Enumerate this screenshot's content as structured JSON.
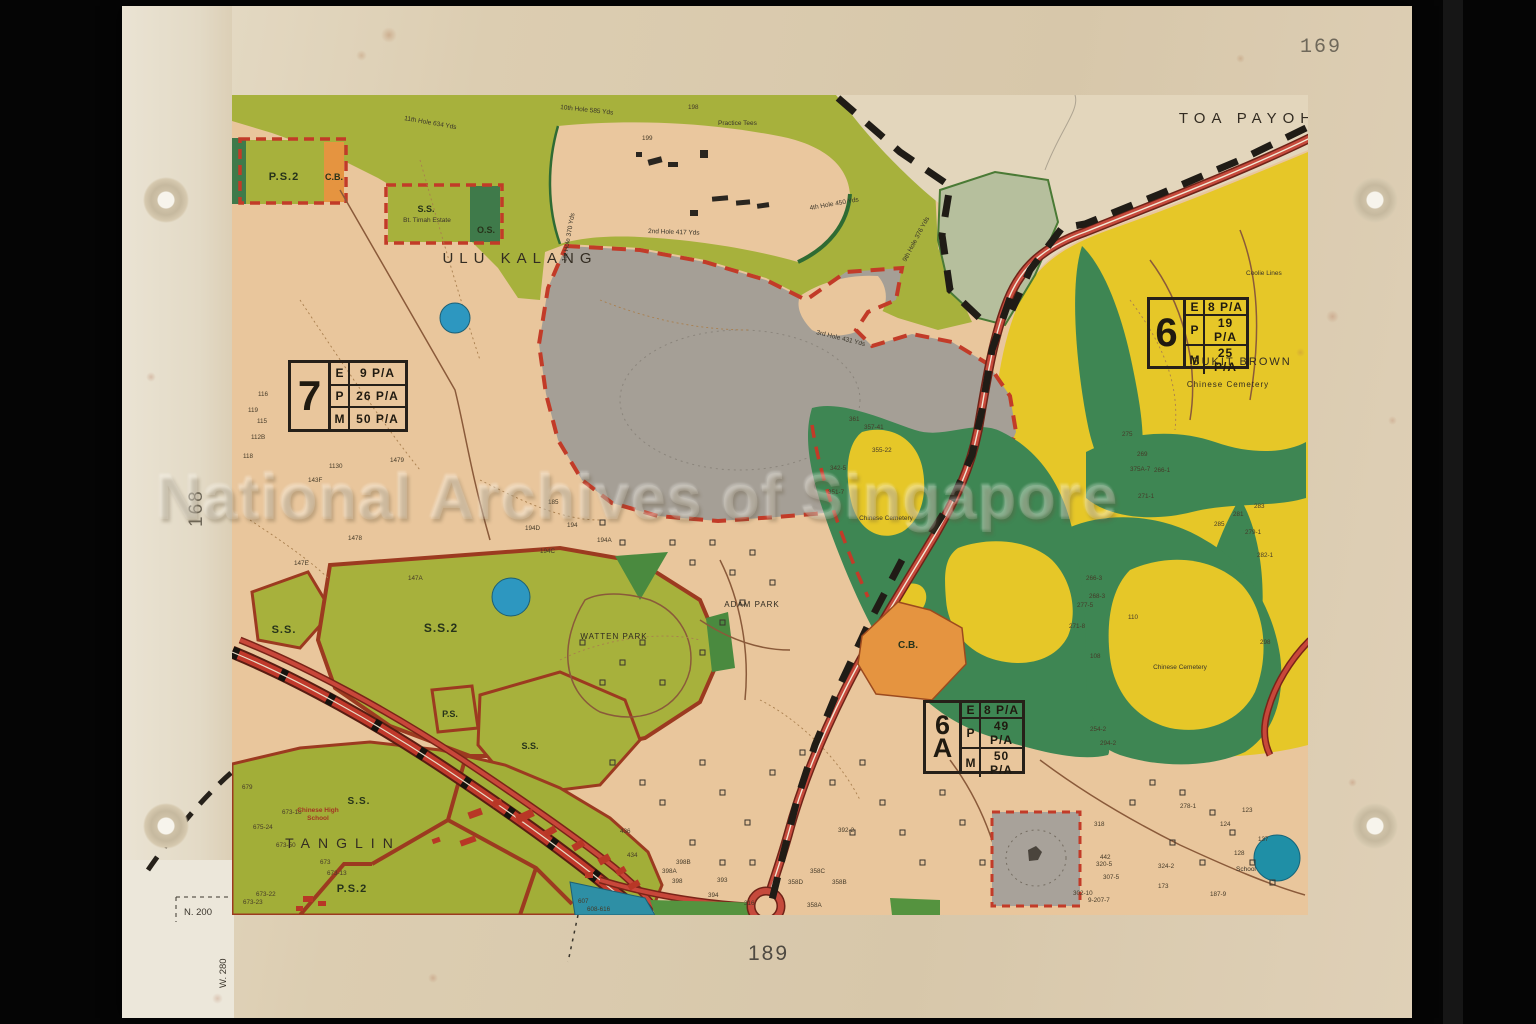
{
  "page": {
    "sheet_number": "169",
    "adjacent_sheet_left": "168",
    "adjacent_sheet_bottom": "189",
    "grid_north_label": "N. 200",
    "grid_west_label": "W. 280"
  },
  "watermark": "National Archives of Singapore",
  "places": {
    "toa_payoh": "TOA PAYOH",
    "ulu_kalang": "ULU KALANG",
    "tanglin": "TANGLIN",
    "ulu_pandan": "ULU PANDAN",
    "bukit_brown": "BUKIT BROWN",
    "adam_park": "ADAM PARK",
    "watten_park": "WATTEN PARK",
    "chinese_cemetery_1": "Chinese Cemetery",
    "chinese_cemetery_2": "Chinese Cemetery",
    "chinese_cemetery_3": "Chinese Cemetery",
    "coolie_lines": "Coolie Lines",
    "practice_tees": "Practice Tees",
    "chinese_high_line1": "Chinese High",
    "chinese_high_line2": "School",
    "school": "School"
  },
  "zones": {
    "ps2_top": "P.S.2",
    "cb_top": "C.B.",
    "ss_estate": "S.S.",
    "bt_timah_estate": "Bt. Timah Estate",
    "os": "O.S.",
    "ss_left": "S.S.",
    "ss2": "S.S.2",
    "ps": "P.S.",
    "ss_mid": "S.S.",
    "ss_tanglin": "S.S.",
    "ps2_bottom": "P.S.2",
    "cb_mid": "C.B."
  },
  "density_boxes": [
    {
      "id_top": "7",
      "id_bottom": "",
      "rows": [
        [
          "E",
          "9 P/A"
        ],
        [
          "P",
          "26 P/A"
        ],
        [
          "M",
          "50 P/A"
        ]
      ]
    },
    {
      "id_top": "6",
      "id_bottom": "",
      "rows": [
        [
          "E",
          "8 P/A"
        ],
        [
          "P",
          "19 P/A"
        ],
        [
          "M",
          "25 P/A"
        ]
      ]
    },
    {
      "id_top": "6",
      "id_bottom": "A",
      "rows": [
        [
          "E",
          "8 P/A"
        ],
        [
          "P",
          "49 P/A"
        ],
        [
          "M",
          "50 P/A"
        ]
      ]
    }
  ],
  "golf_labels": [
    {
      "t": "10th Hole 585 Yds",
      "x": 560,
      "y": 109,
      "r": 6
    },
    {
      "t": "11th Hole 634 Yds",
      "x": 404,
      "y": 120,
      "r": 10
    },
    {
      "t": "2nd Hole 417 Yds",
      "x": 648,
      "y": 233,
      "r": 2
    },
    {
      "t": "4th Hole 450 Yds",
      "x": 810,
      "y": 210,
      "r": -10
    },
    {
      "t": "1st Hole 370 Yds",
      "x": 566,
      "y": 262,
      "r": -80
    },
    {
      "t": "9th Hole 376 Yds",
      "x": 906,
      "y": 262,
      "r": -62
    },
    {
      "t": "3rd Hole 431 Yds",
      "x": 816,
      "y": 334,
      "r": 14
    }
  ],
  "parcel_labels": [
    {
      "t": "116",
      "x": 258,
      "y": 396
    },
    {
      "t": "119",
      "x": 248,
      "y": 412
    },
    {
      "t": "115",
      "x": 257,
      "y": 423
    },
    {
      "t": "112B",
      "x": 251,
      "y": 439
    },
    {
      "t": "118",
      "x": 243,
      "y": 458
    },
    {
      "t": "1130",
      "x": 329,
      "y": 468
    },
    {
      "t": "143F",
      "x": 308,
      "y": 482
    },
    {
      "t": "1479",
      "x": 390,
      "y": 462
    },
    {
      "t": "147E",
      "x": 294,
      "y": 565
    },
    {
      "t": "1478",
      "x": 348,
      "y": 540
    },
    {
      "t": "147A",
      "x": 408,
      "y": 580
    },
    {
      "t": "199",
      "x": 642,
      "y": 140
    },
    {
      "t": "198",
      "x": 688,
      "y": 109
    },
    {
      "t": "185",
      "x": 548,
      "y": 504
    },
    {
      "t": "194",
      "x": 567,
      "y": 527
    },
    {
      "t": "194D",
      "x": 525,
      "y": 530
    },
    {
      "t": "194A",
      "x": 597,
      "y": 542
    },
    {
      "t": "194C",
      "x": 540,
      "y": 553
    },
    {
      "t": "679",
      "x": 242,
      "y": 789
    },
    {
      "t": "673-18",
      "x": 282,
      "y": 814
    },
    {
      "t": "675-24",
      "x": 253,
      "y": 829
    },
    {
      "t": "673-50",
      "x": 276,
      "y": 847
    },
    {
      "t": "673",
      "x": 320,
      "y": 864
    },
    {
      "t": "673-13",
      "x": 327,
      "y": 875
    },
    {
      "t": "673-22",
      "x": 256,
      "y": 896
    },
    {
      "t": "673-23",
      "x": 243,
      "y": 904
    },
    {
      "t": "607",
      "x": 578,
      "y": 903
    },
    {
      "t": "608-616",
      "x": 587,
      "y": 911
    },
    {
      "t": "436",
      "x": 620,
      "y": 833
    },
    {
      "t": "434",
      "x": 627,
      "y": 857
    },
    {
      "t": "398B",
      "x": 676,
      "y": 864
    },
    {
      "t": "398A",
      "x": 662,
      "y": 873
    },
    {
      "t": "398",
      "x": 672,
      "y": 883
    },
    {
      "t": "393",
      "x": 717,
      "y": 882
    },
    {
      "t": "394",
      "x": 708,
      "y": 897
    },
    {
      "t": "316",
      "x": 744,
      "y": 905
    },
    {
      "t": "358D",
      "x": 788,
      "y": 884
    },
    {
      "t": "358B",
      "x": 832,
      "y": 884
    },
    {
      "t": "358C",
      "x": 810,
      "y": 873
    },
    {
      "t": "358A",
      "x": 807,
      "y": 907
    },
    {
      "t": "392-2",
      "x": 838,
      "y": 832
    },
    {
      "t": "318",
      "x": 1094,
      "y": 826
    },
    {
      "t": "442",
      "x": 1100,
      "y": 859
    },
    {
      "t": "320-5",
      "x": 1096,
      "y": 866
    },
    {
      "t": "307-5",
      "x": 1103,
      "y": 879
    },
    {
      "t": "302-10",
      "x": 1073,
      "y": 895
    },
    {
      "t": "9-207-7",
      "x": 1088,
      "y": 902
    },
    {
      "t": "278-1",
      "x": 1180,
      "y": 808
    },
    {
      "t": "324-2",
      "x": 1158,
      "y": 868
    },
    {
      "t": "187-9",
      "x": 1210,
      "y": 896
    },
    {
      "t": "124",
      "x": 1220,
      "y": 826
    },
    {
      "t": "128",
      "x": 1234,
      "y": 855
    },
    {
      "t": "137",
      "x": 1258,
      "y": 841
    },
    {
      "t": "123",
      "x": 1242,
      "y": 812
    },
    {
      "t": "173",
      "x": 1158,
      "y": 888
    },
    {
      "t": "269",
      "x": 1137,
      "y": 456
    },
    {
      "t": "375A-7",
      "x": 1130,
      "y": 471
    },
    {
      "t": "266-1",
      "x": 1154,
      "y": 472
    },
    {
      "t": "275",
      "x": 1122,
      "y": 436
    },
    {
      "t": "271-1",
      "x": 1138,
      "y": 498
    },
    {
      "t": "281",
      "x": 1233,
      "y": 516
    },
    {
      "t": "283",
      "x": 1254,
      "y": 508
    },
    {
      "t": "285",
      "x": 1214,
      "y": 526
    },
    {
      "t": "279-1",
      "x": 1245,
      "y": 534
    },
    {
      "t": "282-1",
      "x": 1257,
      "y": 557
    },
    {
      "t": "266-3",
      "x": 1086,
      "y": 580
    },
    {
      "t": "268-3",
      "x": 1089,
      "y": 598
    },
    {
      "t": "277-5",
      "x": 1077,
      "y": 607
    },
    {
      "t": "271-8",
      "x": 1069,
      "y": 628
    },
    {
      "t": "110",
      "x": 1128,
      "y": 619
    },
    {
      "t": "108",
      "x": 1090,
      "y": 658
    },
    {
      "t": "254-2",
      "x": 1090,
      "y": 731
    },
    {
      "t": "294-2",
      "x": 1100,
      "y": 745
    },
    {
      "t": "298",
      "x": 1260,
      "y": 644
    },
    {
      "t": "361",
      "x": 849,
      "y": 421
    },
    {
      "t": "357-41",
      "x": 864,
      "y": 429
    },
    {
      "t": "342-5",
      "x": 830,
      "y": 470
    },
    {
      "t": "351-7",
      "x": 828,
      "y": 494
    },
    {
      "t": "355-22",
      "x": 872,
      "y": 452
    }
  ],
  "colors": {
    "paper": "#ddd0b6",
    "map_tan": "#e9c69c",
    "olive_green": "#a7b13c",
    "dark_green": "#3e8653",
    "yellow": "#e6c728",
    "grey_area": "#a59f96",
    "sage": "#b6bf9d",
    "orange": "#e59440",
    "road_red": "#c8473a",
    "boundary_black": "#201c16",
    "pond_blue": "#2d97c0",
    "zone_border_red": "#c23b28"
  }
}
